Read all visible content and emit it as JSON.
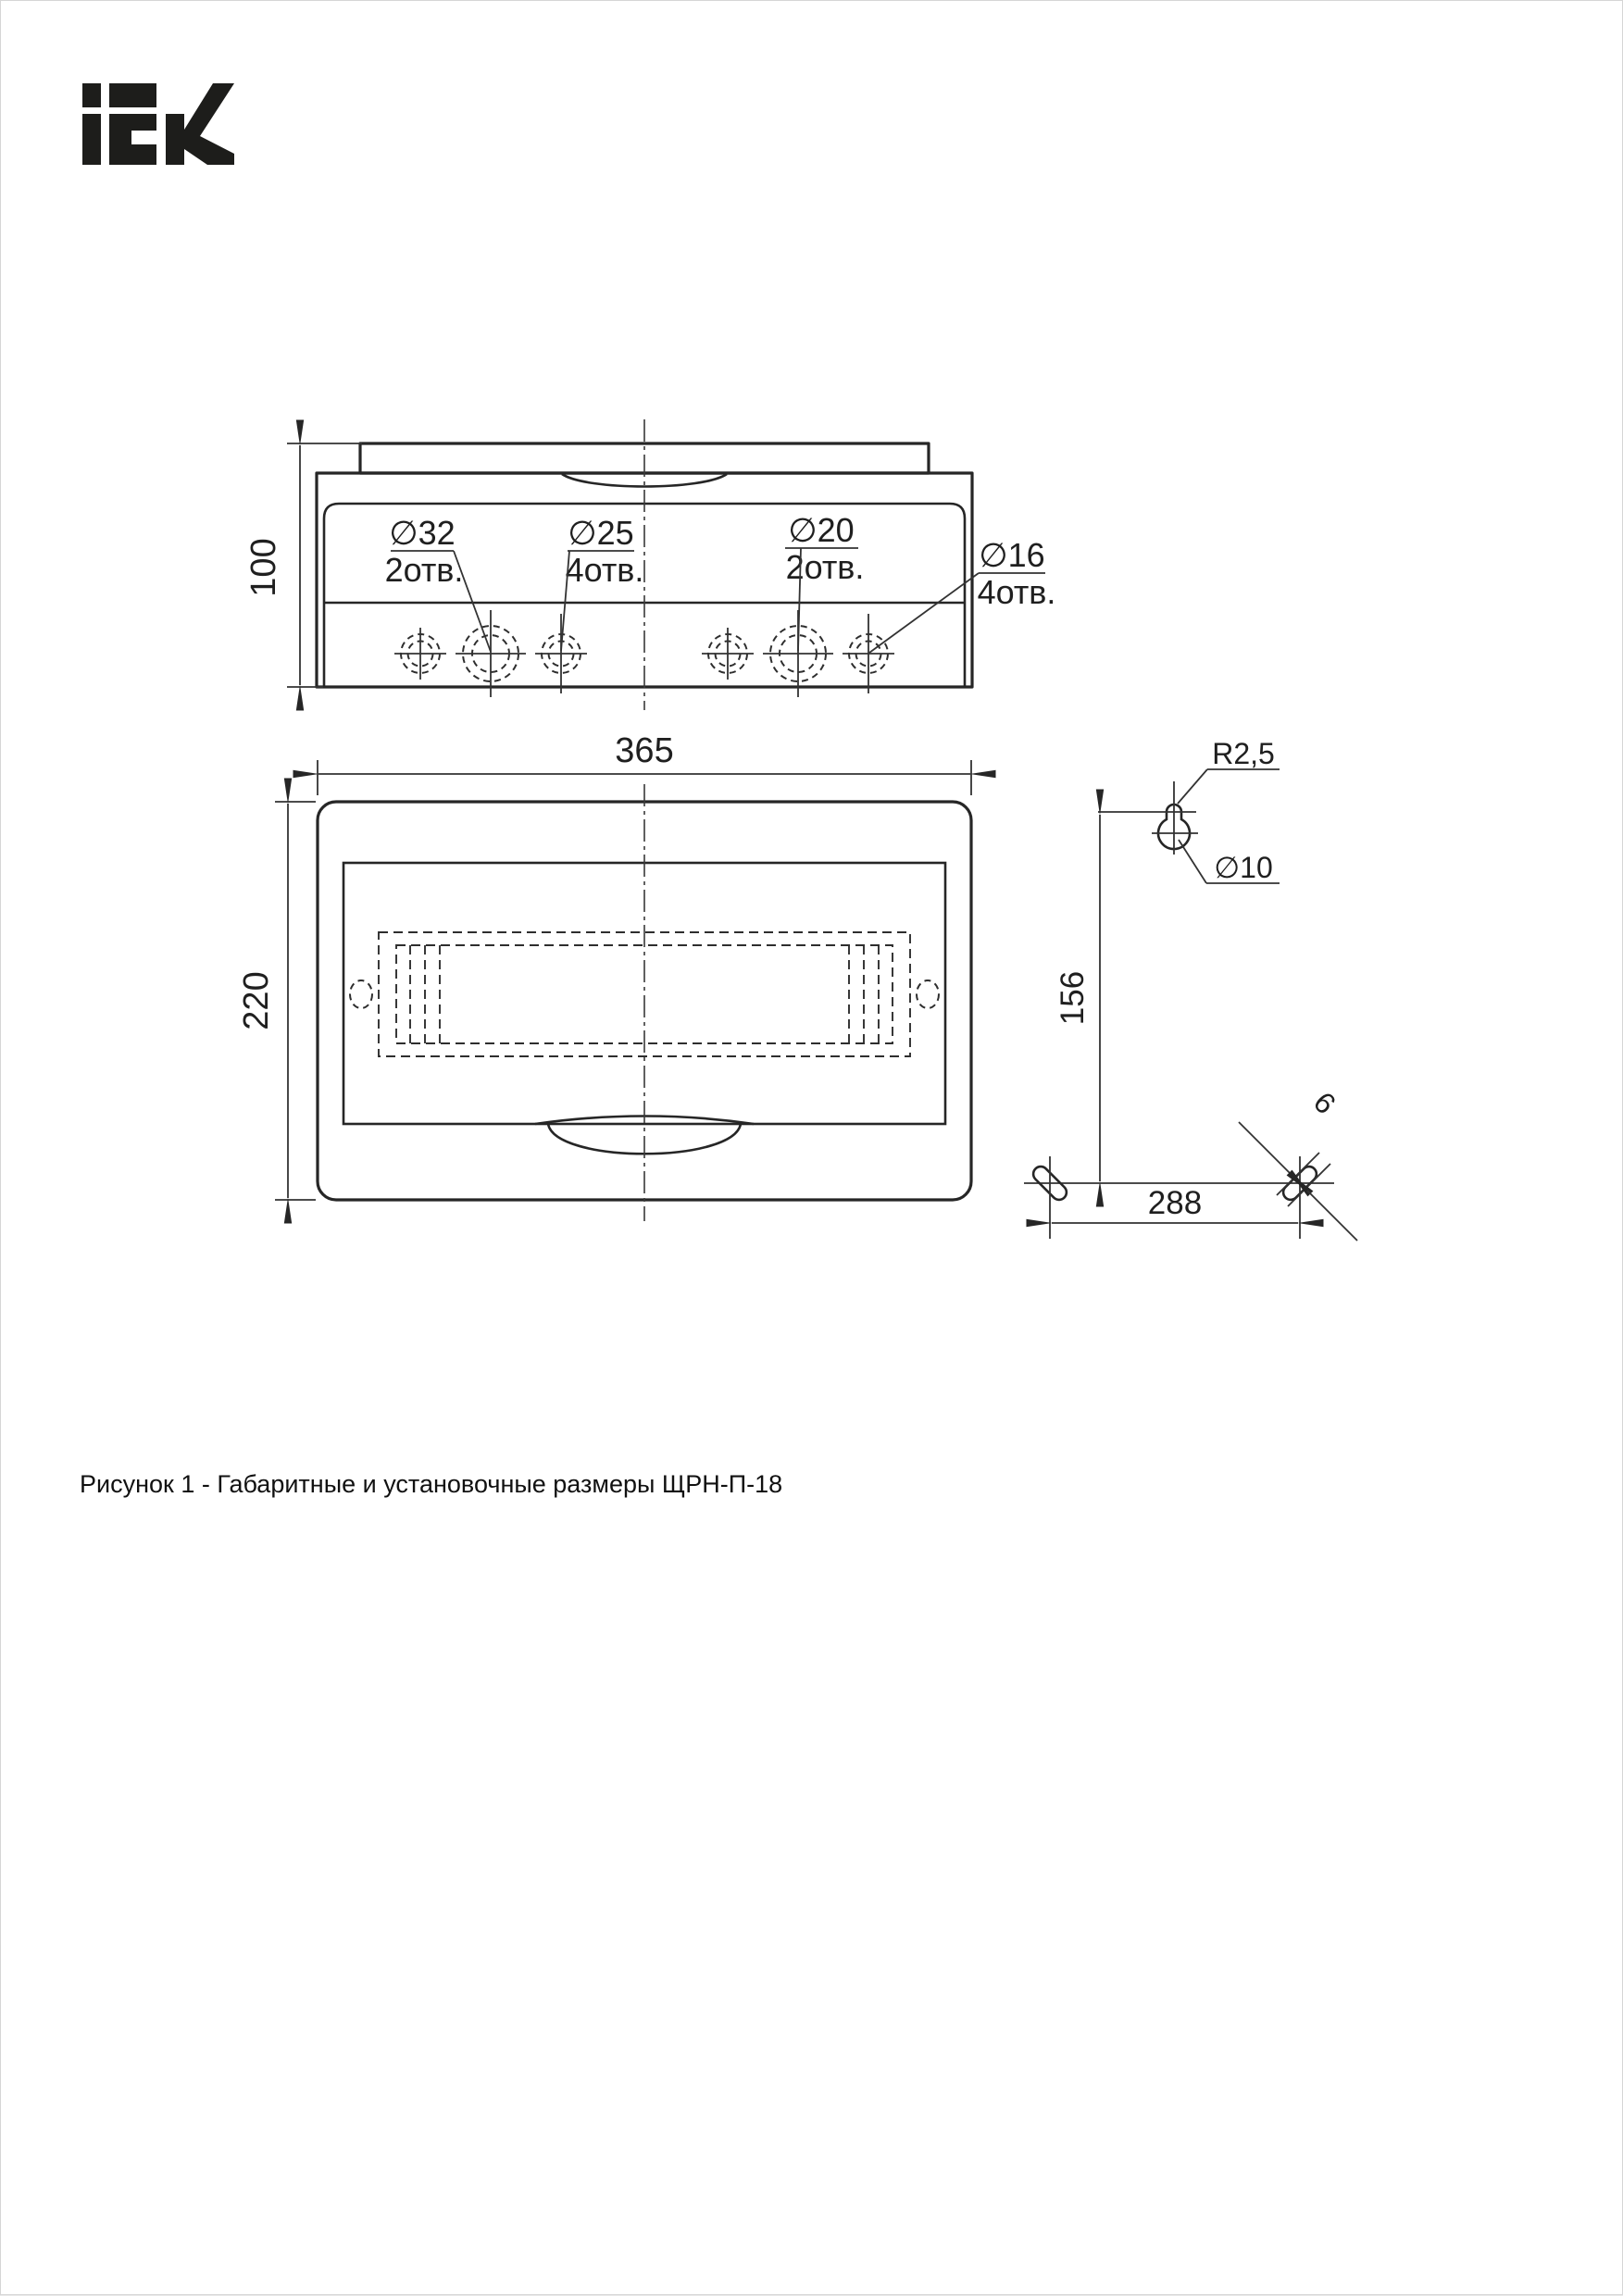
{
  "page": {
    "background": "#ffffff",
    "line_color": "#262626",
    "text_color": "#1f1f1f"
  },
  "logo": {
    "text": "iEK"
  },
  "top_view": {
    "height_dim": "100",
    "callouts": [
      {
        "diameter": "∅32",
        "holes": "2отв."
      },
      {
        "diameter": "∅25",
        "holes": "4отв."
      },
      {
        "diameter": "∅20",
        "holes": "2отв."
      },
      {
        "diameter": "∅16",
        "holes": "4отв."
      }
    ]
  },
  "front_view": {
    "width_dim": "365",
    "height_dim": "220"
  },
  "mounting_view": {
    "corner_radius": "R2,5",
    "hole_diameter": "∅10",
    "vertical_distance": "156",
    "horizontal_distance": "288",
    "slot_width": "6"
  },
  "caption": "Рисунок 1 - Габаритные и установочные размеры ЩРН-П-18"
}
